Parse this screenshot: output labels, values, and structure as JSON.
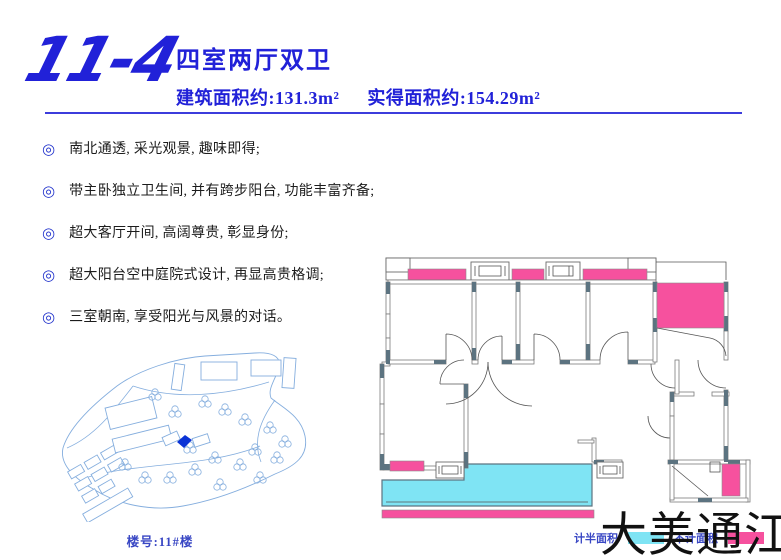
{
  "header": {
    "unit_number": "11-4",
    "title": "四室两厅双卫",
    "built_area": "建筑面积约:131.3m²",
    "actual_area": "实得面积约:154.29m²"
  },
  "features": [
    "南北通透, 采光观景, 趣味即得;",
    "带主卧独立卫生间, 并有跨步阳台, 功能丰富齐备;",
    "超大客厅开间, 高阔尊贵, 彰显身份;",
    "超大阳台空中庭院式设计, 再显高贵格调;",
    "三室朝南, 享受阳光与风景的对话。"
  ],
  "site_plan": {
    "label": "楼号:11#楼"
  },
  "floor_plan": {
    "legend": [
      {
        "label": "计半面积",
        "color": "#7fe4f4"
      },
      {
        "label": "不计面积",
        "color": "#f6519e"
      }
    ]
  },
  "brand": "大美通江",
  "colors": {
    "accent": "#2121d8",
    "rule": "#3c3cdc",
    "bullet": "#2233cc",
    "text": "#1c1c1c",
    "wall": "#5c7380",
    "pink": "#f6519e",
    "cyan": "#7fe4f4",
    "siteplan": "#85aede",
    "marker": "#0a33d6",
    "label_blue": "#3947c4",
    "brand_text": "#111111"
  }
}
